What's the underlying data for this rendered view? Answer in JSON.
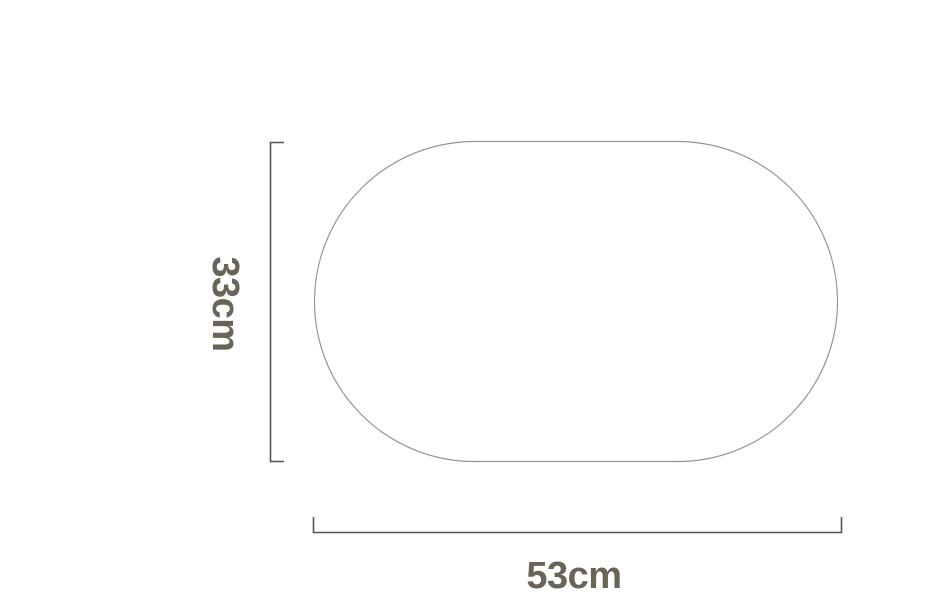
{
  "diagram": {
    "shape_name": "rounded-oval",
    "height": {
      "label": "33cm",
      "value_cm": 33
    },
    "width": {
      "label": "53cm",
      "value_cm": 53
    }
  },
  "colors": {
    "background": "#ffffff",
    "shape_outline": "#969490",
    "dimension_line": "#57544b",
    "label_text": "#6a6357"
  }
}
